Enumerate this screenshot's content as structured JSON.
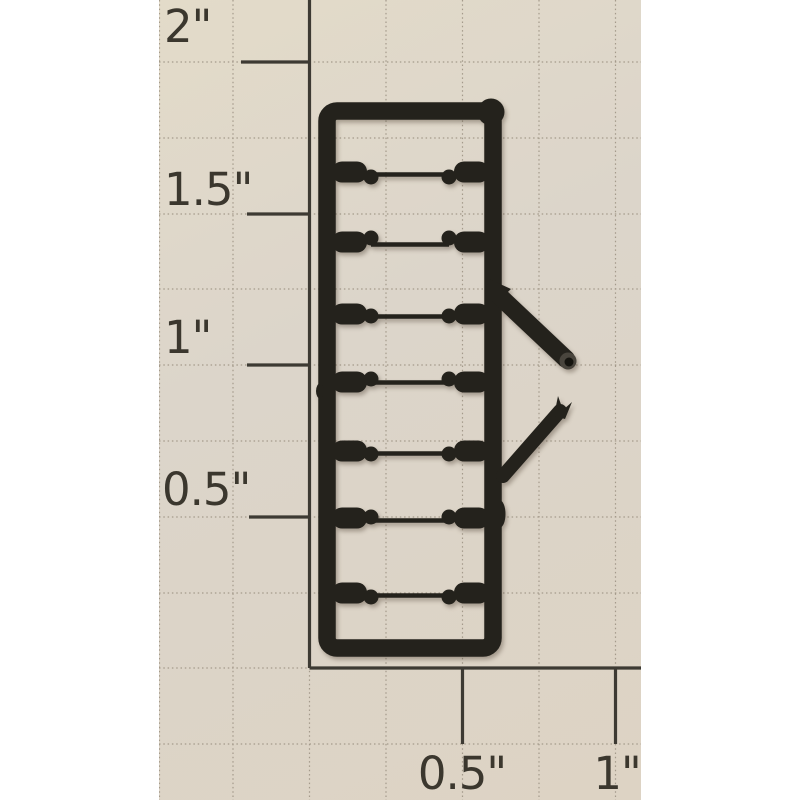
{
  "photo": {
    "description": "Black plastic model ladder sprue with seven rungs and two cut side pins, photographed on inch-grid graph paper",
    "ruler": {
      "vertical_labels": [
        "2\"",
        "1.5\"",
        "1\"",
        "0.5\""
      ],
      "horizontal_labels": [
        "0.5\"",
        "1\""
      ]
    },
    "sprue": {
      "rung_count": 7,
      "side_pins": 2
    },
    "colors": {
      "margin_white": "#ffffff",
      "paper_beige": "#ddd5c7",
      "grid_line": "#a49a8b",
      "ruler_line": "#3d3a33",
      "label_ink": "#3b372e",
      "plastic_black": "#24221c",
      "plastic_cut_face": "#49453d"
    }
  }
}
